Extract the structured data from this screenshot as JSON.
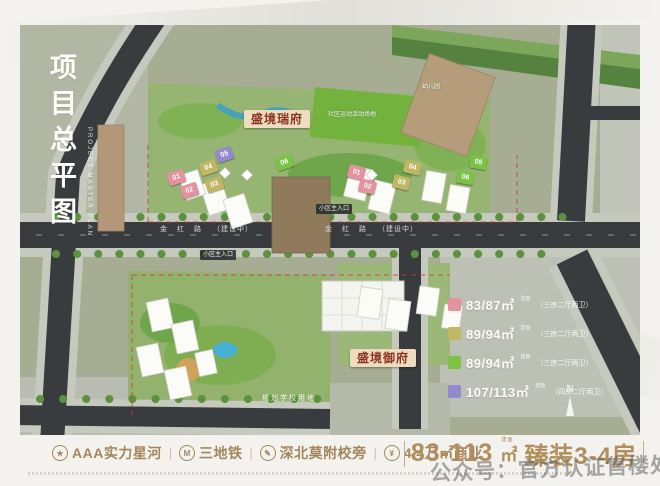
{
  "poster": {
    "title_cn": "项目总平图",
    "title_en": "PROJECT MASTER PLAN"
  },
  "map": {
    "labels": {
      "north_estate": "盛境瑞府",
      "south_estate": "盛境御府",
      "sports_area": "社区运动活动场地",
      "kindergarten": "幼儿园",
      "main_entrance": "小区主入口",
      "school_land": "规划学校用地",
      "compass": "N"
    },
    "road": {
      "name": "金红路",
      "status": "（建设中）"
    },
    "buildings": [
      {
        "num": "01",
        "type": "pink"
      },
      {
        "num": "02",
        "type": "pink"
      },
      {
        "num": "03",
        "type": "olive"
      },
      {
        "num": "04",
        "type": "olive"
      },
      {
        "num": "05",
        "type": "purple"
      },
      {
        "num": "06",
        "type": "green"
      },
      {
        "num": "01",
        "type": "pink"
      },
      {
        "num": "02",
        "type": "pink"
      },
      {
        "num": "03",
        "type": "olive"
      },
      {
        "num": "04",
        "type": "olive"
      },
      {
        "num": "05",
        "type": "green"
      },
      {
        "num": "06",
        "type": "green"
      }
    ],
    "legend": {
      "items": [
        {
          "swatch": "#e6929e",
          "area": "83/87㎡",
          "note": "建面",
          "desc": "（三房二厅两卫）"
        },
        {
          "swatch": "#c0b766",
          "area": "89/94㎡",
          "note": "建面",
          "desc": "（三房二厅两卫）"
        },
        {
          "swatch": "#7cc247",
          "area": "89/94㎡",
          "note": "建面",
          "desc": "（三房二厅两卫）"
        },
        {
          "swatch": "#9289cf",
          "area": "107/113㎡",
          "note": "建面",
          "desc": "（四房二厅两卫）"
        }
      ]
    }
  },
  "footer": {
    "separator": "|",
    "features": [
      {
        "icon": "★",
        "label": "AAA实力星河"
      },
      {
        "icon": "M",
        "label": "三地铁"
      },
      {
        "icon": "✎",
        "label": "深北莫附校旁"
      },
      {
        "icon": "¥",
        "label": "4.4万㎡商业"
      }
    ],
    "headline": {
      "range": "83-113",
      "unit": "㎡",
      "note": "建面",
      "suffix": "臻装3-4房"
    }
  },
  "watermark": "公众号：官方认证售楼处",
  "colors": {
    "map_bg": "#a6ad92",
    "road": "#383c3f",
    "accent_text": "#a2875a",
    "estate_label_bg": "#eedcbf",
    "estate_label_text": "#8c3423",
    "legend_pink": "#e6929e",
    "legend_olive": "#c0b766",
    "legend_green": "#7cc247",
    "legend_purple": "#9289cf"
  }
}
